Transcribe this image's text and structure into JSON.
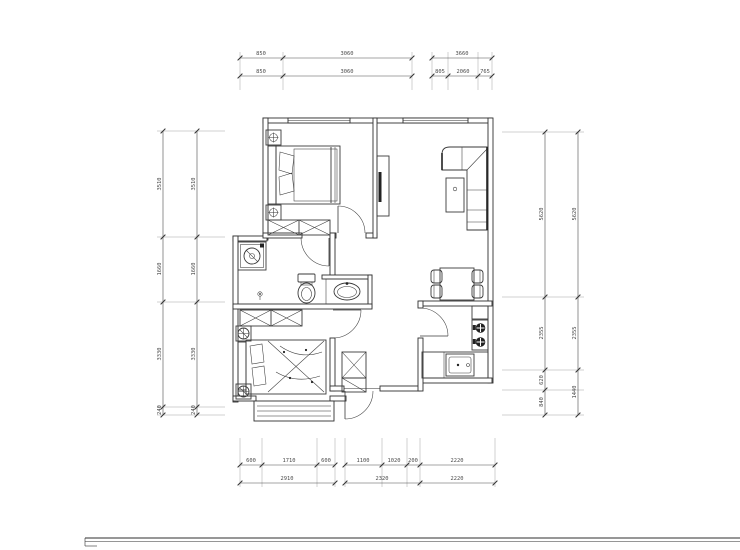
{
  "drawing": {
    "title": "apartment-floor-plan",
    "colors": {
      "background": "#ffffff",
      "wall": "#2f2f2f",
      "furniture": "#3a3a3a",
      "dimension_text": "#4a4a4a"
    },
    "symbols": [
      "double-bed",
      "wardrobe",
      "plant-nightstand",
      "tv-cabinet",
      "l-sofa",
      "coffee-table",
      "dining-table",
      "dining-chair",
      "washing-machine",
      "floor-drain",
      "toilet",
      "washbasin",
      "single-bed",
      "stool",
      "hall-closet",
      "fridge-cabinet",
      "stove-two-burners",
      "kitchen-sink",
      "bay-window",
      "window",
      "door-swing"
    ],
    "dimensions": {
      "top_row1_a": [
        "850",
        "3060"
      ],
      "top_row1_b": [
        "3660"
      ],
      "top_row2_a": [
        "850",
        "3060"
      ],
      "top_row2_b": [
        "805",
        "2060",
        "765"
      ],
      "bottom_row1_a": [
        "600",
        "1710",
        "600"
      ],
      "bottom_row1_b": [
        "1100",
        "1020",
        "200"
      ],
      "bottom_row1_c": [
        "2220"
      ],
      "bottom_row2": [
        "2910",
        "2320",
        "2220"
      ],
      "left_inner": [
        "3510",
        "1660",
        "3330",
        "240"
      ],
      "left_outer": [
        "3510",
        "1660",
        "3330",
        "240"
      ],
      "right_inner": [
        "5620",
        "2355",
        "620",
        "840"
      ],
      "right_outer": [
        "5620",
        "2355",
        "1440"
      ]
    }
  }
}
